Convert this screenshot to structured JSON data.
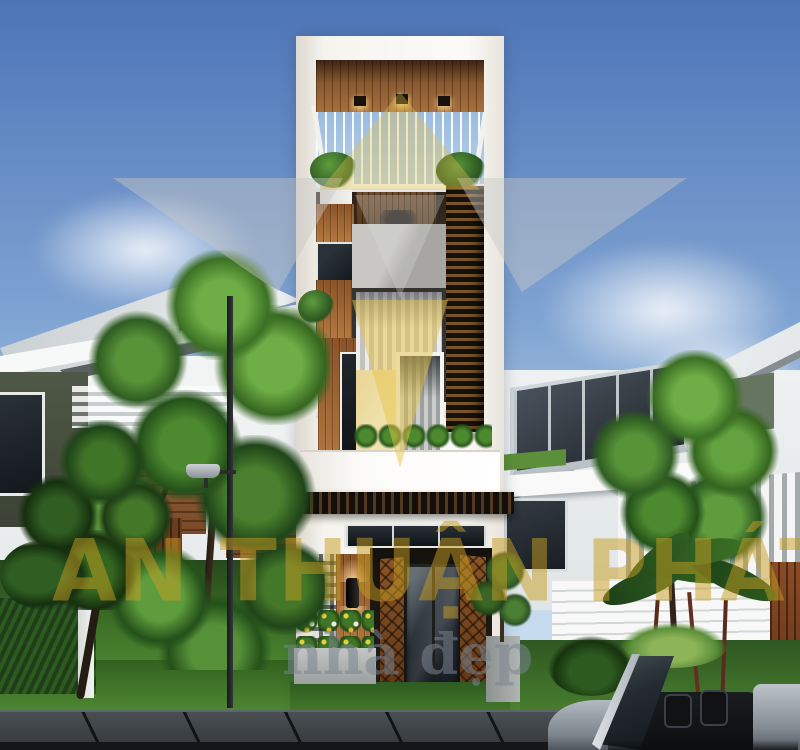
{
  "scene": {
    "description": "Photorealistic 3D exterior render of a modern four-storey narrow tube house with wood, white and dark louver facade, flanked by neighbouring villas, green trees, street lamp, sidewalk and a parked grey convertible car",
    "time_of_day": "day"
  },
  "watermark": {
    "brand": "AN THUẬN PHÁT",
    "tagline": "nhà đẹp"
  },
  "colors": {
    "sky_top": "#4D75B7",
    "sky_mid": "#7FA3D2",
    "sky_horizon": "#C6DCEE",
    "wm_gold": "#C89E23",
    "wm_logo_gray": "#C8C8C6",
    "wm_logo_yellow": "#E6C44A",
    "wall_white": "#F5F3EE",
    "wall_cream": "#E9D695",
    "wood": "#A06434",
    "wood_dark": "#6E4322",
    "louver_light": "#7B5527",
    "louver_dark": "#15120E",
    "glass_dark": "#39414A",
    "roof_gray": "#CFD4D8",
    "accent_olive": "#474F41",
    "lawn": "#4F8A33",
    "lawn_dark": "#2B5220",
    "foliage_light": "#6FAE46",
    "foliage": "#3C7125",
    "foliage_dark": "#1F4419",
    "sidewalk": "#41464A",
    "road": "#17191B",
    "car_body": "#98A0A8",
    "planter_concrete": "#A9ADAB",
    "fence_wood": "#7A4A28",
    "fence_terracotta": "#7D4423",
    "glow_warm": "#FFD798"
  }
}
